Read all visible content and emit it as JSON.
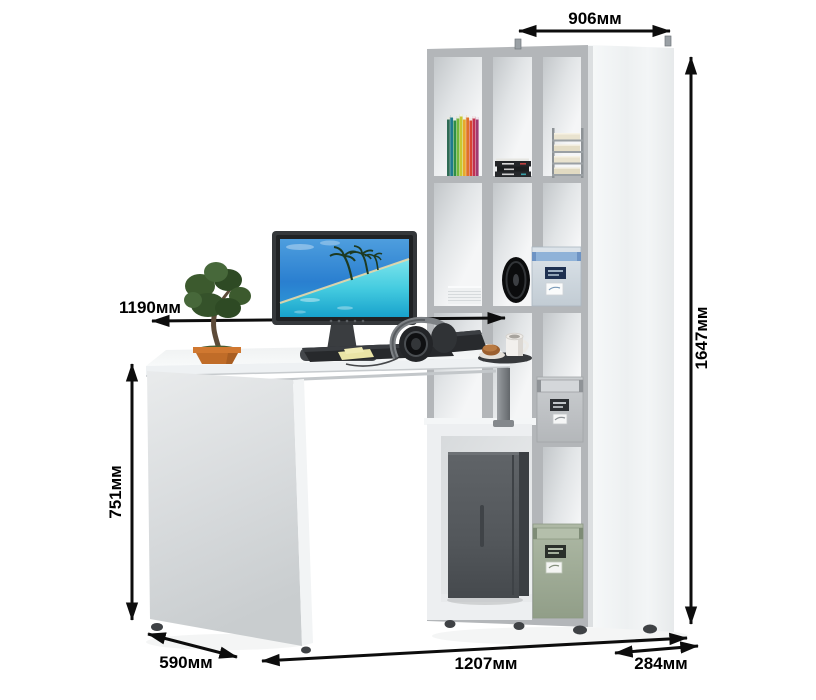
{
  "diagram": {
    "type": "furniture-dimension-diagram",
    "background": "#ffffff",
    "arrow_color": "#0d0d0d",
    "label_color": "#000000",
    "unit": "мм"
  },
  "dimensions": {
    "shelf_width": {
      "text": "906мм",
      "value": 906,
      "orientation": "horizontal"
    },
    "total_height": {
      "text": "1647мм",
      "value": 1647,
      "orientation": "vertical"
    },
    "desktop_width": {
      "text": "1190мм",
      "value": 1190,
      "orientation": "horizontal"
    },
    "desk_height": {
      "text": "751мм",
      "value": 751,
      "orientation": "vertical"
    },
    "desk_depth": {
      "text": "590мм",
      "value": 590,
      "orientation": "diagonal"
    },
    "total_width": {
      "text": "1207мм",
      "value": 1207,
      "orientation": "horizontal"
    },
    "shelf_depth": {
      "text": "284мм",
      "value": 284,
      "orientation": "horizontal"
    }
  },
  "scene": {
    "description": "White computer desk with attached 12-cube shelf column; monitor, bonsai, keyboard, headphones, cup, books, paper trays, storage boxes, speaker and PC tower",
    "colors": {
      "furniture_body": "#eef0f2",
      "shelf_frame": "#b3b6b9",
      "pc_case": "#53575b",
      "storage_box_blue": "#cfd8e0",
      "storage_box_gray": "#c2c5c8",
      "storage_box_green": "#a5b19c",
      "plant_pot": "#c06c28",
      "book_spines": [
        "#2f6b55",
        "#1f7a8c",
        "#2f8f46",
        "#74b83a",
        "#c8c832",
        "#e8a82a",
        "#e07028",
        "#d84432",
        "#c23050",
        "#a03a72"
      ]
    }
  }
}
